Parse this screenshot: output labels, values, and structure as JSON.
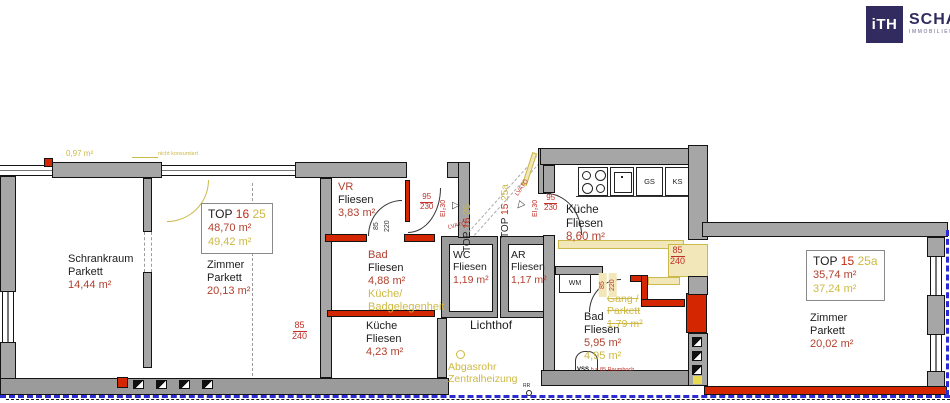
{
  "logo": {
    "monogram": "iTH",
    "brand": "SCHANTL",
    "subtitle": "IMMOBILIENTREUHAND"
  },
  "units": {
    "top16": {
      "label": "TOP",
      "number": "16",
      "alt": "25",
      "area": "48,70 m²",
      "area_alt": "49,42 m²"
    },
    "top15": {
      "label": "TOP",
      "number": "15",
      "alt": "25a",
      "area": "35,74 m²",
      "area_alt": "37,24 m²"
    }
  },
  "rooms": {
    "schrankraum": {
      "name": "Schrankraum",
      "floor": "Parkett",
      "area": "14,44 m²"
    },
    "zimmer16": {
      "name": "Zimmer",
      "floor": "Parkett",
      "area": "20,13 m²"
    },
    "vr": {
      "name": "VR",
      "floor": "Fliesen",
      "area": "3,83 m²"
    },
    "bad16": {
      "name": "Bad",
      "floor": "Fliesen",
      "area": "4,88 m²",
      "note1": "Küche/",
      "note2": "Badgelegenheit"
    },
    "kueche16": {
      "name": "Küche",
      "floor": "Fliesen",
      "area": "4,23 m²"
    },
    "wc": {
      "name": "WC",
      "floor": "Fliesen",
      "area": "1,19 m²"
    },
    "ar": {
      "name": "AR",
      "floor": "Fliesen",
      "area": "1,17 m²"
    },
    "lichthof": {
      "name": "Lichthof"
    },
    "kueche15": {
      "name": "Küche",
      "floor": "Fliesen",
      "area": "8,60 m²"
    },
    "bad15": {
      "name": "Bad",
      "floor": "Fliesen",
      "area": "5,95 m²",
      "area_alt": "4,95 m²"
    },
    "gang": {
      "name": "Gang /",
      "floor": "Parkett",
      "area": "1,79 m²"
    },
    "zimmer15": {
      "name": "Zimmer",
      "floor": "Parkett",
      "area": "20,02 m²"
    }
  },
  "annotations": {
    "area_small": "0,97 m²",
    "note_small": "nicht konsumiert",
    "lvato": "LVATÖ",
    "ei30": "EI₂30",
    "d95": "95",
    "d230": "230",
    "d85": "85",
    "d240": "240",
    "d220": "220",
    "wm": "WM",
    "gs": "GS",
    "ks": "KS",
    "vss": "VSS",
    "vss_note": "h = 85 Raumhoch",
    "rr": "RR",
    "abgas1": "Abgasrohr",
    "abgas2": "Zentralheizung"
  },
  "colors": {
    "wall_gray": "#a6a6a6",
    "wall_new_red": "#d42600",
    "demolition_yellow": "#f1e7b8",
    "text_red": "#b2402e",
    "text_yellow": "#cdb944",
    "boundary_blue": "#2b2bd4",
    "logo_navy": "#322b5f"
  }
}
